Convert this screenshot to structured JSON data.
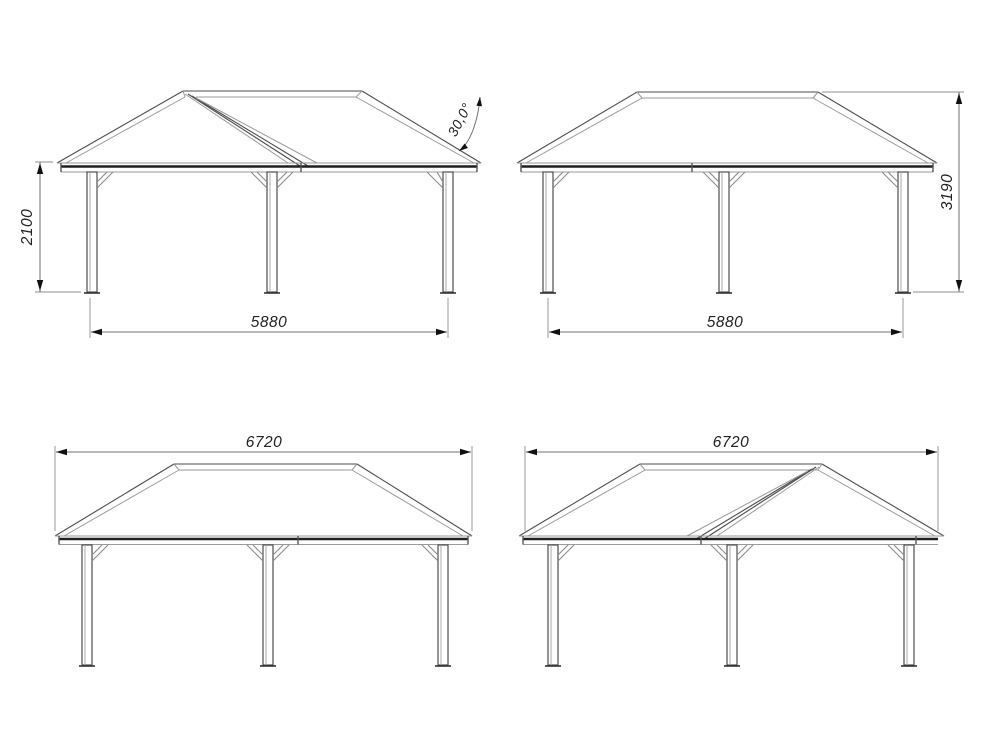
{
  "document": {
    "title": "gazebo-four-elevation-drawing",
    "background_color": "#ffffff",
    "line_color": "#4d4d4d"
  },
  "views": [
    {
      "name": "elevation-gable-left",
      "position": "top-left",
      "dimensions": {
        "post_height": "2100",
        "post_spacing": "5880",
        "roof_pitch": "30,0°"
      }
    },
    {
      "name": "elevation-hip-roof-a",
      "position": "top-right",
      "dimensions": {
        "overall_height": "3190",
        "post_spacing": "5880"
      }
    },
    {
      "name": "elevation-hip-roof-b",
      "position": "bottom-left",
      "dimensions": {
        "roof_width": "6720"
      }
    },
    {
      "name": "elevation-gable-right",
      "position": "bottom-right",
      "dimensions": {
        "roof_width": "6720"
      }
    }
  ]
}
